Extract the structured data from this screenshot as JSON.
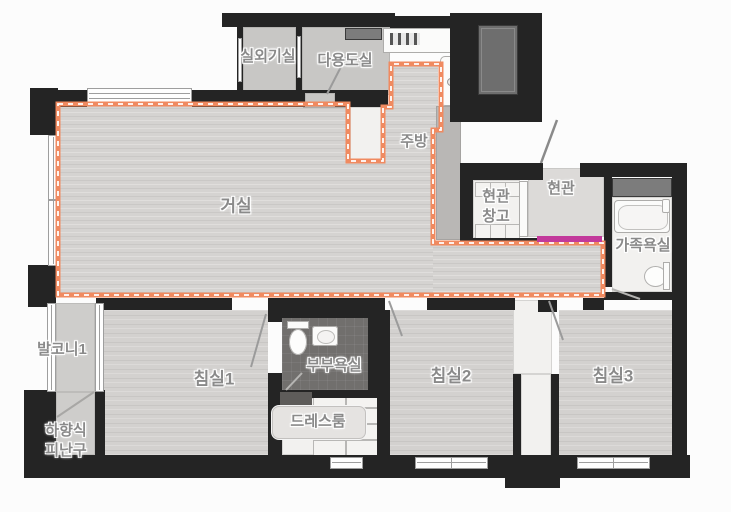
{
  "page": {
    "background": "#fcfcfc"
  },
  "colors": {
    "wall": "#242424",
    "wood_floor": "#d5d3d1",
    "gray_floor": "#c8c7c5",
    "entrance_tile": "#dcdad8",
    "master_bath_tile": "#716f6d",
    "white_floor": "#f2f1ef",
    "extension_outline": "#f08a60",
    "entry_marker": "#c2399b",
    "shaft_gray": "#6e6e6e",
    "label_text": "#8a8a8a"
  },
  "rooms": [
    {
      "id": "outdoor-unit-room",
      "label": "실외기실"
    },
    {
      "id": "utility-room",
      "label": "다용도실"
    },
    {
      "id": "kitchen",
      "label": "주방"
    },
    {
      "id": "living-room",
      "label": "거실"
    },
    {
      "id": "entrance-storage",
      "line1": "현관",
      "line2": "창고"
    },
    {
      "id": "entrance",
      "label": "현관"
    },
    {
      "id": "family-bathroom",
      "label": "가족욕실"
    },
    {
      "id": "balcony1",
      "label": "발코니1"
    },
    {
      "id": "bedroom1",
      "label": "침실1"
    },
    {
      "id": "master-bathroom",
      "label": "부부욕실"
    },
    {
      "id": "dress-room",
      "label": "드레스룸"
    },
    {
      "id": "bedroom2",
      "label": "침실2"
    },
    {
      "id": "bedroom3",
      "label": "침실3"
    },
    {
      "id": "escape-hatch",
      "line1": "하향식",
      "line2": "피난구"
    }
  ]
}
